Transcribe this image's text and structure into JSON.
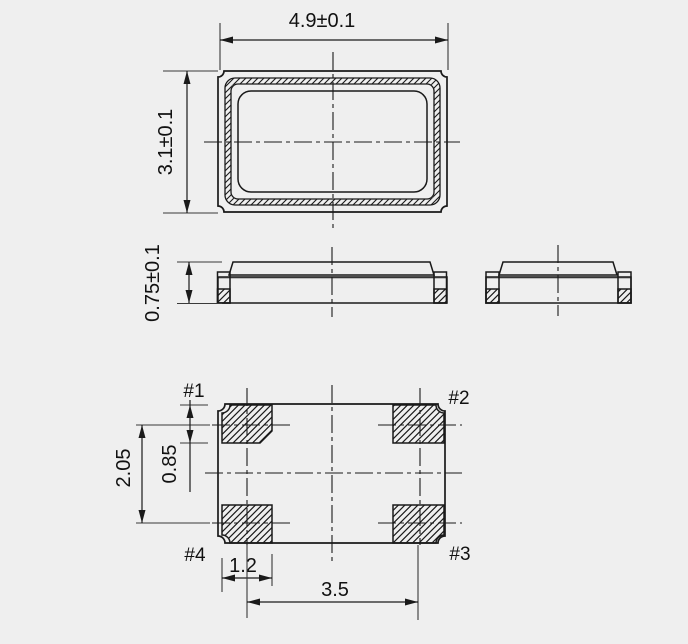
{
  "colors": {
    "background": "#efefef",
    "line": "#1a1a1a",
    "gray_line": "#8a8a8a",
    "text": "#111111"
  },
  "top_view": {
    "width_dim": "4.9±0.1",
    "height_dim": "3.1±0.1"
  },
  "side_view": {
    "height_dim": "0.75±0.1"
  },
  "bottom_view": {
    "pad_labels": {
      "pad1": "#1",
      "pad2": "#2",
      "pad3": "#3",
      "pad4": "#4"
    },
    "dims": {
      "vertical_pitch": "2.05",
      "pad_height": "0.85",
      "pad_width": "1.2",
      "horizontal_pitch": "3.5"
    }
  }
}
